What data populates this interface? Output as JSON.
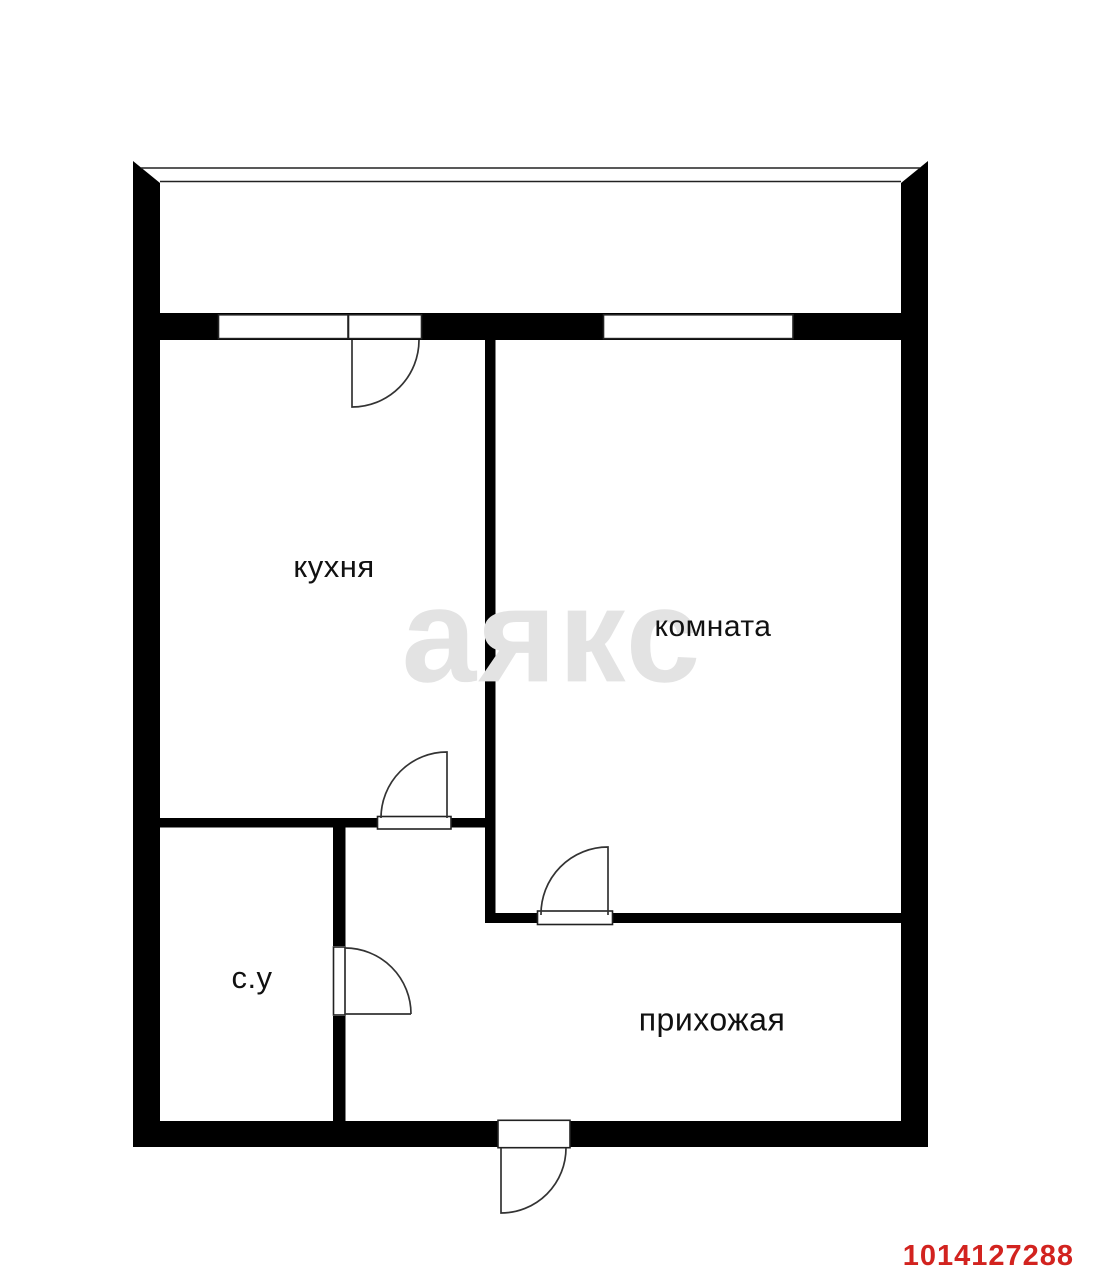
{
  "floorplan": {
    "watermark_text": "аякс",
    "listing_id": "1014127288",
    "rooms": [
      {
        "id": "kitchen",
        "label": "кухня"
      },
      {
        "id": "room",
        "label": "комната"
      },
      {
        "id": "bathroom",
        "label": "с.у"
      },
      {
        "id": "hallway",
        "label": "прихожая"
      }
    ],
    "colors": {
      "walls": "#000000",
      "thin_lines": "#222222",
      "door_swings": "#333333",
      "watermark": "#e3e3e3",
      "listing_id": "#d2231f"
    }
  }
}
